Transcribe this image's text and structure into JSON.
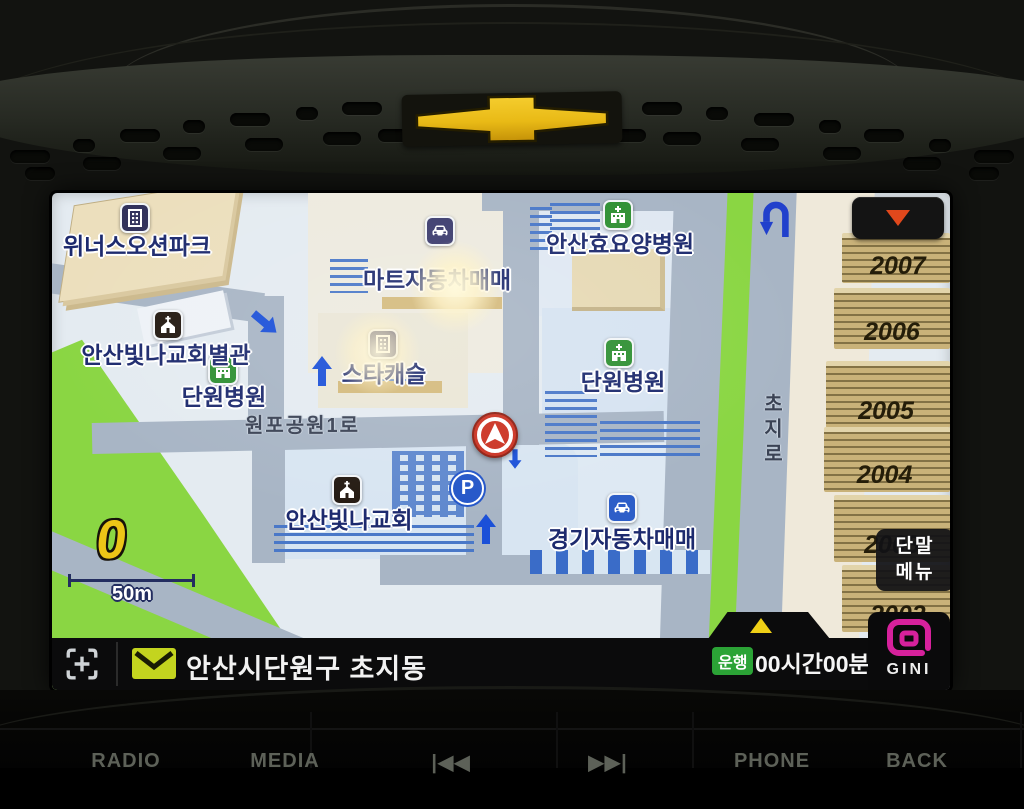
{
  "device": {
    "brand": "Chevrolet"
  },
  "map": {
    "pois": [
      {
        "label": "위너스오션파크",
        "icon": "building-icon"
      },
      {
        "label": "마트자동차매매",
        "icon": "car-dealer-icon"
      },
      {
        "label": "안산효요양병원",
        "icon": "hospital-icon"
      },
      {
        "label": "안산빛나교회별관",
        "icon": "church-icon"
      },
      {
        "label": "단원병원",
        "icon": "hospital-icon"
      },
      {
        "label": "스타캐슬",
        "icon": "building-icon"
      },
      {
        "label": "단원병원",
        "icon": "hospital-icon"
      },
      {
        "label": "안산빛나교회",
        "icon": "church-icon"
      },
      {
        "label": "경기자동차매매",
        "icon": "car-dealer-icon"
      }
    ],
    "road_labels": [
      {
        "label": "원포공원1로"
      },
      {
        "label": "초지로"
      }
    ],
    "buildings": [
      {
        "number": "2007"
      },
      {
        "number": "2006"
      },
      {
        "number": "2005"
      },
      {
        "number": "2004"
      },
      {
        "number": "2003"
      },
      {
        "number": "2002"
      }
    ],
    "scale": {
      "label": "50m"
    },
    "speed": {
      "value": "0"
    },
    "markers": {
      "parking_label": "P"
    }
  },
  "overlay": {
    "terminal_menu": {
      "line1": "단말",
      "line2": "메뉴"
    }
  },
  "status_bar": {
    "location": "안산시단원구 초지동",
    "drive_badge": "운행",
    "drive_time": "00시간00분",
    "brand_text": "GINI"
  },
  "hardware_buttons": [
    {
      "label": "RADIO"
    },
    {
      "label": "MEDIA"
    },
    {
      "label": "|◀◀"
    },
    {
      "label": "▶▶|"
    },
    {
      "label": "PHONE"
    },
    {
      "label": "BACK"
    }
  ],
  "colors": {
    "gini_magenta": "#d6219c",
    "drive_green": "#2ba336",
    "envelope_yellow": "#c3d41f",
    "chevy_gold": "#e9ba16",
    "marker_red": "#cb3222",
    "map_green": "#8ad643",
    "road_gray": "#a8b5c5",
    "alert_triangle_yellow": "#efd016",
    "scroll_triangle_red": "#e0481c"
  }
}
